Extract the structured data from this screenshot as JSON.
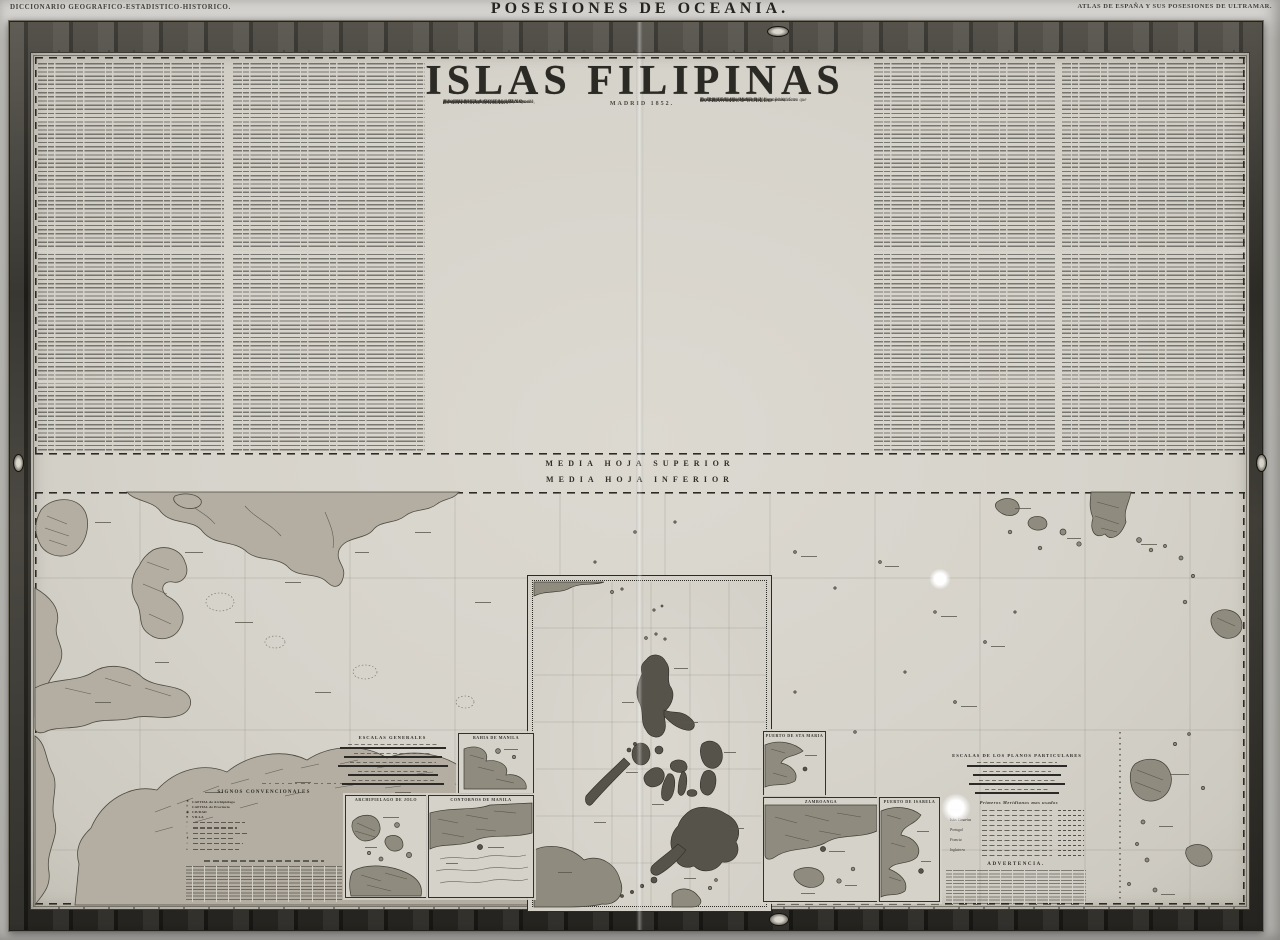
{
  "header": {
    "left": "DICCIONARIO GEOGRAFICO-ESTADISTICO-HISTORICO.",
    "center": "POSESIONES DE OCEANIA.",
    "right": "ATLAS DE ESPAÑA Y SUS POSESIONES DE ULTRAMAR."
  },
  "title_block": {
    "title": "ISLAS FILIPINAS",
    "date": "MADRID 1852.",
    "left_credit": [
      "Este mapa ha sido formado en escala mayor",
      "por el Señor",
      "D. ANTONIO MORATA",
      "Secretario de la Intendencia general,",
      "Superintendencia de Filipinas;",
      "el cual, como piloto que fué de la Real Armada,",
      "hizo parte de la comision hidrográfica",
      "destinada á levantar los mapas de las Islas del",
      "ARCHIPIELAGO FILIPINO."
    ],
    "right_credit": [
      "La Publicacion del está hecha",
      "con ligeras adiciones por",
      "D. FRANCISCO COELLO",
      "Teniente Coronel,",
      "Capitan del Cuerpo Nacional de Ingenieros;",
      "el cual ha aumentado todos los planos particulares que",
      "le acompañan, y las notas estadísticas é históricas",
      "escritas por",
      "D. PASCUAL MADOZ."
    ]
  },
  "dividers": {
    "upper": "MEDIA HOJA SUPERIOR",
    "lower": "MEDIA HOJA INFERIOR"
  },
  "upper_map": {
    "labels": {
      "islas": "ISLAS",
      "batanes": "BATANES",
      "bachi": "BACHI",
      "gran_paso": "Gran paso",
      "canal_balintang": "Canal de Balintang",
      "babuyanes": "ISLAS BABUYANES"
    }
  },
  "lower_map": {
    "scales_general_title": "ESCALAS GENERALES",
    "legend": {
      "title": "SIGNOS CONVENCIONALES",
      "visible_items": [
        "CAPITAL de Archipiélago",
        "CAPITAL de Provincia",
        "CIUDAD",
        "VILLA"
      ]
    },
    "insets": {
      "manila_bay": "BAHIA DE MANILA",
      "jolo": "ARCHIPIELAGO DE JOLO",
      "contornos": "CONTORNOS DE MANILA",
      "sta_maria": "PUERTO DE STA MARIA",
      "zamboanga": "ZAMBOANGA",
      "isabela": "PUERTO DE ISABELA"
    },
    "plan_scales_title": "ESCALAS DE LOS PLANOS PARTICULARES",
    "meridians_table": {
      "title": "Primeros Meridianos mas usados",
      "groups": [
        "España",
        "Islas Canarias",
        "Portugal",
        "Francia",
        "Inglaterra"
      ]
    },
    "advertencia_title": "ADVERTENCIA."
  },
  "colors": {
    "paper": "#d7d4cc",
    "ink": "#2e2c28",
    "frame": "#312f2b",
    "land": "#b3aea1"
  }
}
